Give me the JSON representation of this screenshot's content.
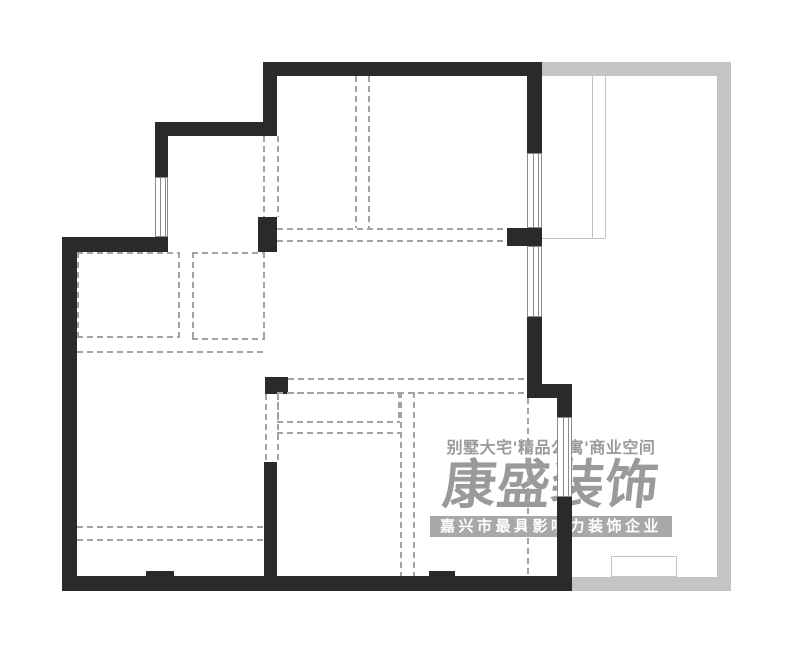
{
  "colors": {
    "wall": "#2a2a2a",
    "gray_wall": "#c4c4c4",
    "dash": "#a3a3a3",
    "thin": "#c2c2c2",
    "window_line": "#8a8a8a",
    "watermark": "#9a9a9a",
    "banner_bg": "#a8a8a8",
    "banner_text": "#ffffff",
    "background": "#ffffff"
  },
  "watermark": {
    "tagline": "别墅大宅'精品公寓'商业空间",
    "logo": "康盛装饰",
    "banner": "嘉兴市最具影响力装饰企业"
  },
  "plan": {
    "walls": [
      {
        "x": 263,
        "y": 62,
        "w": 279,
        "h": 14
      },
      {
        "x": 263,
        "y": 62,
        "w": 14,
        "h": 60
      },
      {
        "x": 155,
        "y": 122,
        "w": 122,
        "h": 14
      },
      {
        "x": 155,
        "y": 136,
        "w": 13,
        "h": 41
      },
      {
        "x": 62,
        "y": 237,
        "w": 106,
        "h": 15
      },
      {
        "x": 62,
        "y": 237,
        "w": 15,
        "h": 354
      },
      {
        "x": 62,
        "y": 576,
        "w": 510,
        "h": 15
      },
      {
        "x": 146,
        "y": 571,
        "w": 28,
        "h": 5
      },
      {
        "x": 429,
        "y": 571,
        "w": 26,
        "h": 5
      },
      {
        "x": 527,
        "y": 62,
        "w": 15,
        "h": 91
      },
      {
        "x": 507,
        "y": 228,
        "w": 35,
        "h": 18
      },
      {
        "x": 527,
        "y": 317,
        "w": 15,
        "h": 67
      },
      {
        "x": 527,
        "y": 384,
        "w": 45,
        "h": 14
      },
      {
        "x": 557,
        "y": 398,
        "w": 15,
        "h": 19
      },
      {
        "x": 557,
        "y": 497,
        "w": 15,
        "h": 94
      },
      {
        "x": 258,
        "y": 217,
        "w": 19,
        "h": 35
      },
      {
        "x": 265,
        "y": 377,
        "w": 23,
        "h": 17
      },
      {
        "x": 264,
        "y": 462,
        "w": 13,
        "h": 114
      }
    ],
    "gray_walls": [
      {
        "x": 542,
        "y": 62,
        "w": 189,
        "h": 14
      },
      {
        "x": 717,
        "y": 62,
        "w": 14,
        "h": 529
      },
      {
        "x": 572,
        "y": 577,
        "w": 159,
        "h": 14
      }
    ],
    "windows": [
      {
        "x": 155,
        "y": 177,
        "w": 13,
        "h": 60,
        "orient": "v"
      },
      {
        "x": 527,
        "y": 153,
        "w": 15,
        "h": 75,
        "orient": "v"
      },
      {
        "x": 527,
        "y": 246,
        "w": 15,
        "h": 71,
        "orient": "v"
      },
      {
        "x": 557,
        "y": 417,
        "w": 15,
        "h": 80,
        "orient": "v"
      }
    ],
    "dashed_lines": [
      {
        "x": 263,
        "y": 136,
        "len": 81,
        "dir": "v"
      },
      {
        "x": 277,
        "y": 136,
        "len": 81,
        "dir": "v"
      },
      {
        "x": 355,
        "y": 76,
        "len": 152,
        "dir": "v"
      },
      {
        "x": 368,
        "y": 76,
        "len": 152,
        "dir": "v"
      },
      {
        "x": 277,
        "y": 228,
        "len": 230,
        "dir": "h"
      },
      {
        "x": 277,
        "y": 240,
        "len": 230,
        "dir": "h"
      },
      {
        "x": 288,
        "y": 378,
        "len": 239,
        "dir": "h"
      },
      {
        "x": 288,
        "y": 392,
        "len": 239,
        "dir": "h"
      },
      {
        "x": 265,
        "y": 394,
        "len": 68,
        "dir": "v"
      },
      {
        "x": 277,
        "y": 394,
        "len": 68,
        "dir": "v"
      },
      {
        "x": 77,
        "y": 351,
        "len": 188,
        "dir": "h"
      },
      {
        "x": 77,
        "y": 526,
        "len": 187,
        "dir": "h"
      },
      {
        "x": 77,
        "y": 539,
        "len": 187,
        "dir": "h"
      },
      {
        "x": 277,
        "y": 432,
        "len": 123,
        "dir": "h"
      },
      {
        "x": 400,
        "y": 392,
        "len": 184,
        "dir": "v"
      },
      {
        "x": 413,
        "y": 392,
        "len": 184,
        "dir": "v"
      },
      {
        "x": 527,
        "y": 398,
        "len": 178,
        "dir": "v"
      }
    ],
    "dashed_rects": [
      {
        "x": 77,
        "y": 252,
        "w": 103,
        "h": 86
      },
      {
        "x": 192,
        "y": 252,
        "w": 73,
        "h": 88
      },
      {
        "x": 277,
        "y": 392,
        "w": 123,
        "h": 31
      }
    ],
    "thin_lines": [
      {
        "x": 592,
        "y": 76,
        "len": 162,
        "dir": "v"
      },
      {
        "x": 605,
        "y": 76,
        "len": 162,
        "dir": "v"
      },
      {
        "x": 542,
        "y": 238,
        "len": 63,
        "dir": "h"
      }
    ],
    "thin_rects": [
      {
        "x": 611,
        "y": 556,
        "w": 66,
        "h": 21
      }
    ]
  }
}
